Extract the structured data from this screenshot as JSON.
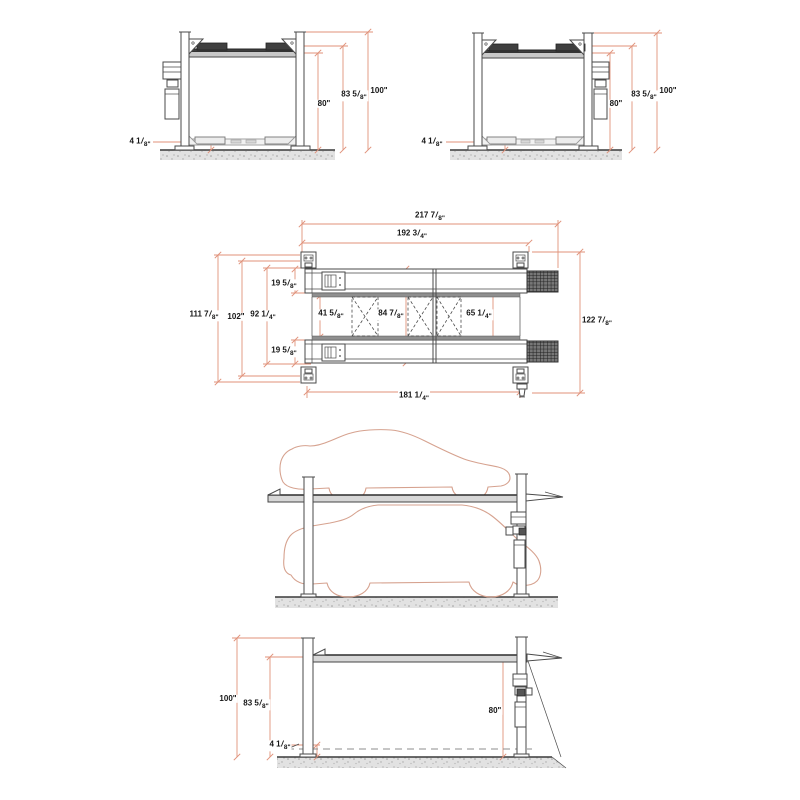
{
  "drawing": {
    "description": "Dimensional specification drawing of a four-post automotive parking lift, five orthographic views",
    "colors": {
      "line": "#4a4a4a",
      "dim": "#e0927a",
      "car": "#d6a28f",
      "ground": "#e2e2e2",
      "speckle": "#9d9d9d"
    },
    "views": [
      {
        "id": "end-elevation-a",
        "label": "End elevation, lift raised, power unit on left post"
      },
      {
        "id": "end-elevation-b",
        "label": "End elevation, lift raised, power unit on right post"
      },
      {
        "id": "plan",
        "label": "Plan view with runways, ramps and cross rails"
      },
      {
        "id": "side-elevation-cars",
        "label": "Side elevation with parked vehicles above and below"
      },
      {
        "id": "side-elevation-dims",
        "label": "Side elevation with height dimensions"
      }
    ],
    "dim_labels": [
      {
        "view": "end-elevation-a",
        "x": 379,
        "y": 91,
        "text": "100\""
      },
      {
        "view": "end-elevation-a",
        "x": 354,
        "y": 96,
        "text": "83 5/8\""
      },
      {
        "view": "end-elevation-a",
        "x": 324,
        "y": 104,
        "text": "80\""
      },
      {
        "view": "end-elevation-a",
        "x": 140,
        "y": 143,
        "text": "4 1/8\""
      },
      {
        "view": "end-elevation-b",
        "x": 668,
        "y": 91,
        "text": "100\""
      },
      {
        "view": "end-elevation-b",
        "x": 644,
        "y": 96,
        "text": "83 5/8\""
      },
      {
        "view": "end-elevation-b",
        "x": 616,
        "y": 104,
        "text": "80\""
      },
      {
        "view": "end-elevation-b",
        "x": 432,
        "y": 143,
        "text": "4 1/8\""
      },
      {
        "view": "plan",
        "x": 430,
        "y": 217,
        "text": "217 7/8\""
      },
      {
        "view": "plan",
        "x": 412,
        "y": 235,
        "text": "192 3/4\""
      },
      {
        "view": "plan",
        "x": 204,
        "y": 316,
        "text": "111 7/8\""
      },
      {
        "view": "plan",
        "x": 236,
        "y": 317,
        "text": "102\""
      },
      {
        "view": "plan",
        "x": 263,
        "y": 316,
        "text": "92 1/4\""
      },
      {
        "view": "plan",
        "x": 284,
        "y": 285,
        "text": "19 5/8\""
      },
      {
        "view": "plan",
        "x": 284,
        "y": 352,
        "text": "19 5/8\""
      },
      {
        "view": "plan",
        "x": 331,
        "y": 315,
        "text": "41 5/8\""
      },
      {
        "view": "plan",
        "x": 391,
        "y": 315,
        "text": "84 7/8\""
      },
      {
        "view": "plan",
        "x": 479,
        "y": 315,
        "text": "65 1/4\""
      },
      {
        "view": "plan",
        "x": 414,
        "y": 397,
        "text": "181 1/4\""
      },
      {
        "view": "plan",
        "x": 597,
        "y": 322,
        "text": "122 7/8\""
      },
      {
        "view": "side-elevation-dims",
        "x": 228,
        "y": 699,
        "text": "100\""
      },
      {
        "view": "side-elevation-dims",
        "x": 256,
        "y": 705,
        "text": "83 5/8\""
      },
      {
        "view": "side-elevation-dims",
        "x": 280,
        "y": 746,
        "text": "4 1/8\""
      },
      {
        "view": "side-elevation-dims",
        "x": 495,
        "y": 711,
        "text": "80\""
      }
    ]
  }
}
